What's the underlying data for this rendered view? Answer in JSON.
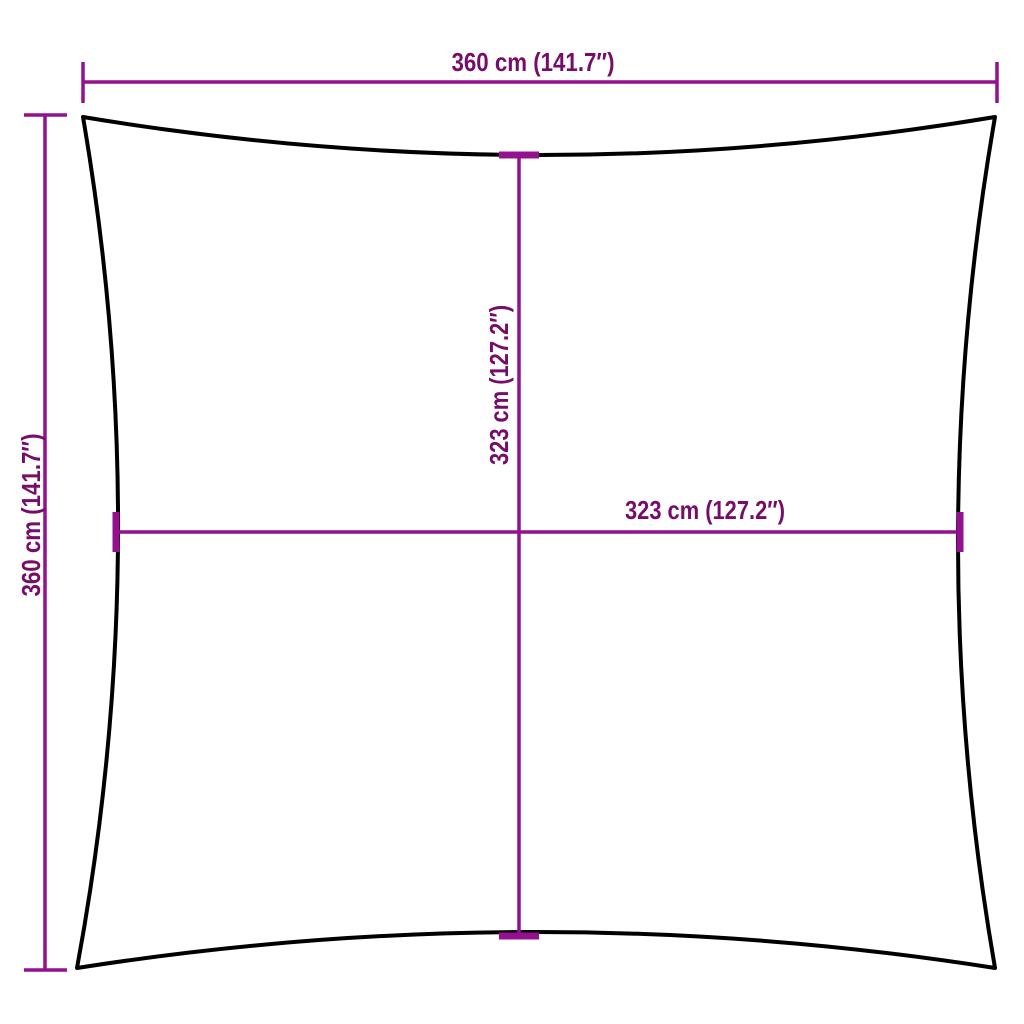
{
  "diagram": {
    "kind": "square-shade-sail-dimension-diagram",
    "shape": "square outline with concave (inward-curved) edges"
  },
  "colors": {
    "dimension_line": "#93108f",
    "label_text": "#760d6a",
    "sail_outline": "#000000",
    "background": "#ffffff"
  },
  "dimensions": {
    "top_width": {
      "label": "360 cm (141.7″)",
      "value_cm": 360,
      "value_in": 141.7
    },
    "left_height": {
      "label": "360 cm (141.7″)",
      "value_cm": 360,
      "value_in": 141.7
    },
    "inner_height": {
      "label": "323 cm (127.2″)",
      "value_cm": 323,
      "value_in": 127.2
    },
    "inner_width": {
      "label": "323 cm (127.2″)",
      "value_cm": 323,
      "value_in": 127.2
    }
  }
}
